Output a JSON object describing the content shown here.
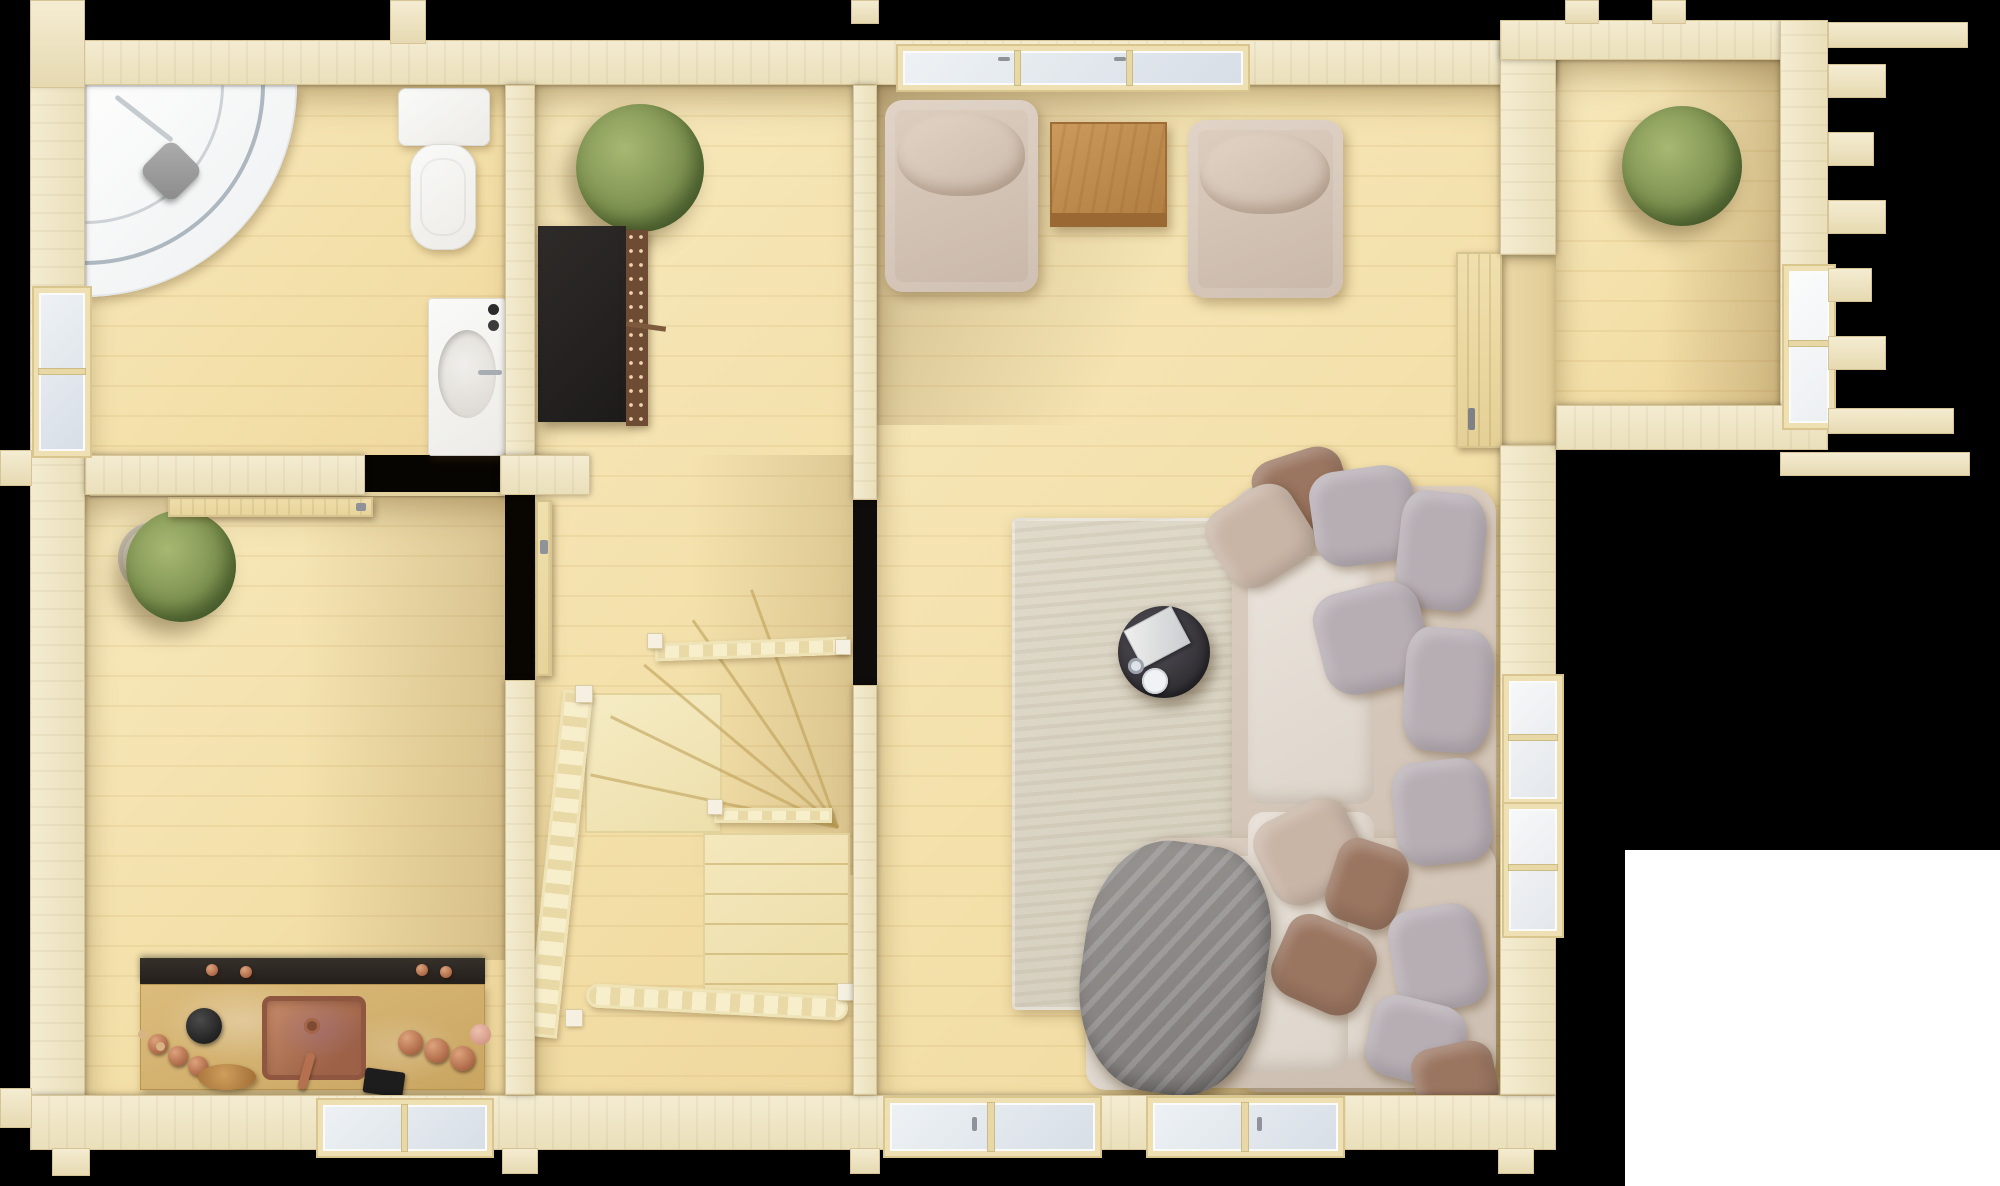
{
  "scene": {
    "kind": "3d-top-down-floor-plan-render",
    "subject": "single-storey-log-cabin-interior",
    "background_color": "#000000",
    "corner_cutout_color": "#ffffff",
    "wood_tone": "light-pine"
  },
  "palette": {
    "wall": "#f0e6c8",
    "wall_edge": "#d7c597",
    "floor": "#f4e2ac",
    "glass": "#e2e9ef",
    "frame": "#eee0b2",
    "white_fixture": "#f4f2ee",
    "shower_head": "#9a9a9a",
    "shelf_black": "#262423",
    "shelf_side_copper": "#6e4c33",
    "plant_green": "#7d9150",
    "pot": "#dbd5c8",
    "armchair": "#d8c9bb",
    "side_table": "#bf8a4b",
    "rug": "#dbd5c7",
    "coffee_table": "#3a383a",
    "book": "#e9e9e7",
    "sofa_base": "#d5c8bb",
    "sofa_seat": "#e6dfd6",
    "pillow_gray": "#b7aeb4",
    "pillow_brown": "#9a7560",
    "pillow_beige": "#c9b5a6",
    "blanket": "#8d8a89",
    "counter_top": "#d6b475",
    "counter_back": "#2c2824",
    "copper": "#bc7e5c",
    "stair_wood": "#f2e6bc",
    "door_wood": "#ecd9a6"
  },
  "rooms": {
    "bathroom": {
      "fixtures": [
        "corner-shower",
        "toilet",
        "sink-vanity",
        "left-wall-window",
        "sliding-door-to-kitchen"
      ]
    },
    "kitchen": {
      "fixtures": [
        "wall-plant",
        "kitchen-counter",
        "copper-sink",
        "wine-bottles",
        "copper-canisters",
        "wooden-bowl",
        "tablet",
        "bottom-wall-window",
        "door-to-hall"
      ]
    },
    "entry": {
      "fixtures": [
        "potted-plant",
        "black-shelf"
      ]
    },
    "stair-hall": {
      "fixtures": [
        "winder-staircase",
        "ladder-railings",
        "doorway-to-living-room"
      ]
    },
    "living-room": {
      "fixtures": [
        "armchair-left",
        "armchair-right",
        "side-table",
        "long-top-window",
        "area-rug",
        "round-coffee-table",
        "book",
        "two-cups",
        "corner-sofa",
        "seat-cushions",
        "throw-pillows",
        "gray-blanket",
        "bottom-french-windows",
        "right-wall-windows",
        "door-to-annex"
      ]
    },
    "annex": {
      "fixtures": [
        "potted-plant",
        "right-wall-window",
        "protruding-log-ends"
      ]
    }
  },
  "counts": {
    "rooms": 6,
    "plants": 3,
    "armchairs": 2,
    "pillows_gray": 7,
    "pillows_brown": 4,
    "pillows_beige": 2,
    "windows": 8,
    "doors": 4,
    "wine_bottles": 4,
    "copper_canisters": 4
  }
}
